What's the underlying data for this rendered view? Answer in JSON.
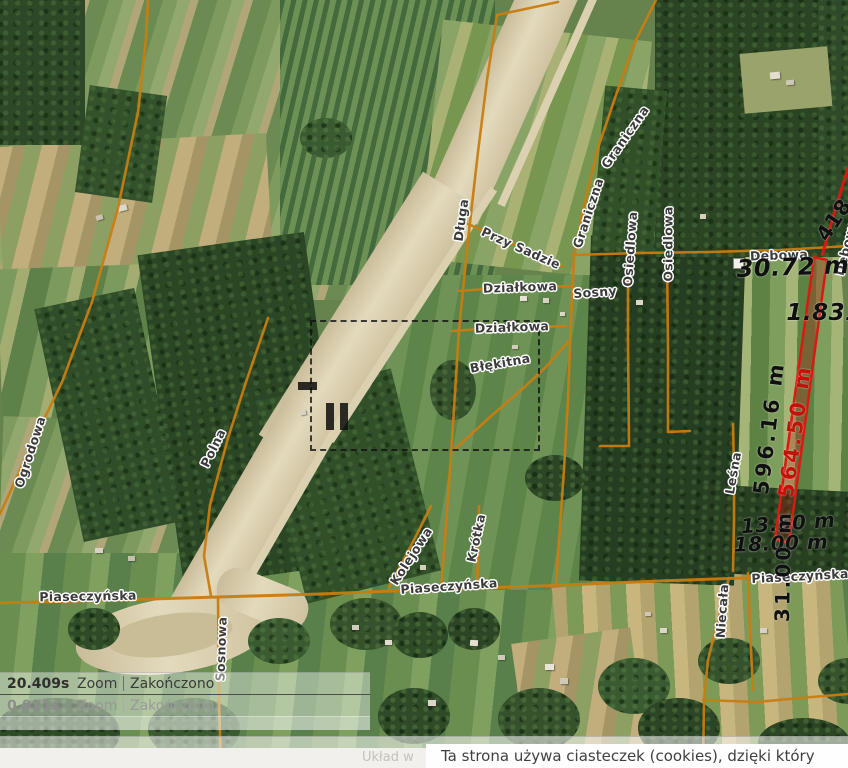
{
  "street_labels": [
    {
      "text": "Ogrodowa",
      "x": 30,
      "y": 452,
      "rot": -72
    },
    {
      "text": "Polna",
      "x": 213,
      "y": 448,
      "rot": -64
    },
    {
      "text": "Piaseczyńska",
      "x": 88,
      "y": 596,
      "rot": -1
    },
    {
      "text": "Sosnowa",
      "x": 221,
      "y": 649,
      "rot": -88
    },
    {
      "text": "Długa",
      "x": 461,
      "y": 220,
      "rot": -82
    },
    {
      "text": "Przy Sadzie",
      "x": 521,
      "y": 248,
      "rot": 24
    },
    {
      "text": "Graniczna",
      "x": 625,
      "y": 137,
      "rot": -55
    },
    {
      "text": "Graniczna",
      "x": 588,
      "y": 213,
      "rot": -72
    },
    {
      "text": "Osiedlowa",
      "x": 630,
      "y": 249,
      "rot": -86
    },
    {
      "text": "Osiedlowa",
      "x": 668,
      "y": 244,
      "rot": -90
    },
    {
      "text": "Działkowa",
      "x": 520,
      "y": 287,
      "rot": -2
    },
    {
      "text": "Sosny",
      "x": 595,
      "y": 292,
      "rot": -4
    },
    {
      "text": "Działkowa",
      "x": 512,
      "y": 327,
      "rot": -2
    },
    {
      "text": "Błękitna",
      "x": 500,
      "y": 363,
      "rot": -10
    },
    {
      "text": "Kolejowa",
      "x": 411,
      "y": 556,
      "rot": -57
    },
    {
      "text": "Krótka",
      "x": 476,
      "y": 538,
      "rot": -78
    },
    {
      "text": "Piaseczyńska",
      "x": 449,
      "y": 586,
      "rot": -4
    },
    {
      "text": "Leśna",
      "x": 733,
      "y": 473,
      "rot": -80
    },
    {
      "text": "Niecała",
      "x": 722,
      "y": 611,
      "rot": -86
    },
    {
      "text": "Piaseczyńska",
      "x": 800,
      "y": 576,
      "rot": -3
    },
    {
      "text": "Dębowa",
      "x": 779,
      "y": 255,
      "rot": -2
    },
    {
      "text": "Dębowa",
      "x": 846,
      "y": 247,
      "rot": -76
    }
  ],
  "measurements": [
    {
      "text": "30.72 m",
      "x": 793,
      "y": 267,
      "rot": -2,
      "size": 24,
      "italic": true,
      "color": "#101010"
    },
    {
      "text": "1.831",
      "x": 824,
      "y": 313,
      "rot": 0,
      "size": 23,
      "italic": true,
      "color": "#101010"
    },
    {
      "text": "418",
      "x": 834,
      "y": 220,
      "rot": -56,
      "size": 21,
      "italic": false,
      "color": "#101010"
    },
    {
      "text": "596.16 m",
      "x": 769,
      "y": 428,
      "rot": -83,
      "size": 21,
      "italic": false,
      "color": "#101010"
    },
    {
      "text": "564.50 m",
      "x": 795,
      "y": 431,
      "rot": -82,
      "size": 21,
      "italic": false,
      "color": "#c41208"
    },
    {
      "text": "13.50 m",
      "x": 788,
      "y": 523,
      "rot": -4,
      "size": 20,
      "italic": true,
      "color": "#101010"
    },
    {
      "text": "18.00 m",
      "x": 781,
      "y": 543,
      "rot": -2,
      "size": 20,
      "italic": true,
      "color": "#101010"
    },
    {
      "text": "31.00 m",
      "x": 783,
      "y": 566,
      "rot": -89,
      "size": 20,
      "italic": false,
      "color": "#101010"
    }
  ],
  "timing_panel": {
    "rows": [
      {
        "time": "20.409s",
        "action": "Zoom",
        "status": "Zakończono"
      },
      {
        "time": "0.921s",
        "action": "Zoom",
        "status": "Zakończono"
      }
    ]
  },
  "footer": {
    "coord_text": "Układ w",
    "cookie_notice": "Ta strona używa ciasteczek (cookies), dzięki który"
  },
  "colors": {
    "road": "#c87d12",
    "measure_red": "#da1910",
    "label_text": "#3b3b3b"
  }
}
